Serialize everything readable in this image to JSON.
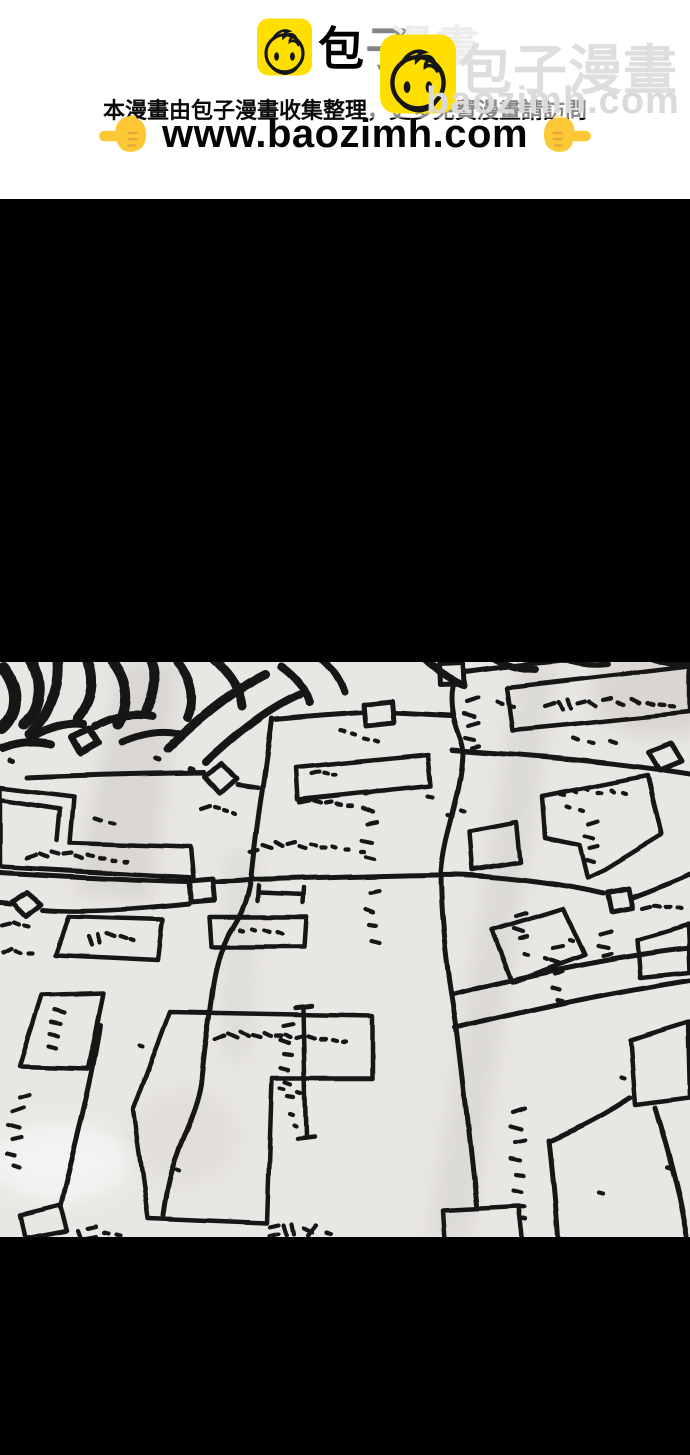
{
  "header": {
    "logo": {
      "icon": "baozi-bun-icon",
      "brand_black": "包子",
      "brand_faded": "漫畫"
    },
    "watermark": {
      "icon": "baozi-bun-icon",
      "brand": "包子漫畫",
      "domain": "baozimh.com"
    },
    "notice": "本漫畫由包子漫畫收集整理，更多免費漫畫請訪問",
    "url_line": {
      "left_icon": "pointing-right-hand-icon",
      "url": "www.baozimh.com",
      "right_icon": "pointing-left-hand-icon"
    }
  },
  "panel": {
    "content_icon": "hand-drawn-street-map-sketch"
  },
  "colors": {
    "brand_yellow": "#ffdf00",
    "hand_yellow": "#fdc835",
    "watermark_gray": "#dedede",
    "paper": "#e9e7e3",
    "ink": "#161616",
    "letterbox_black": "#000000"
  }
}
